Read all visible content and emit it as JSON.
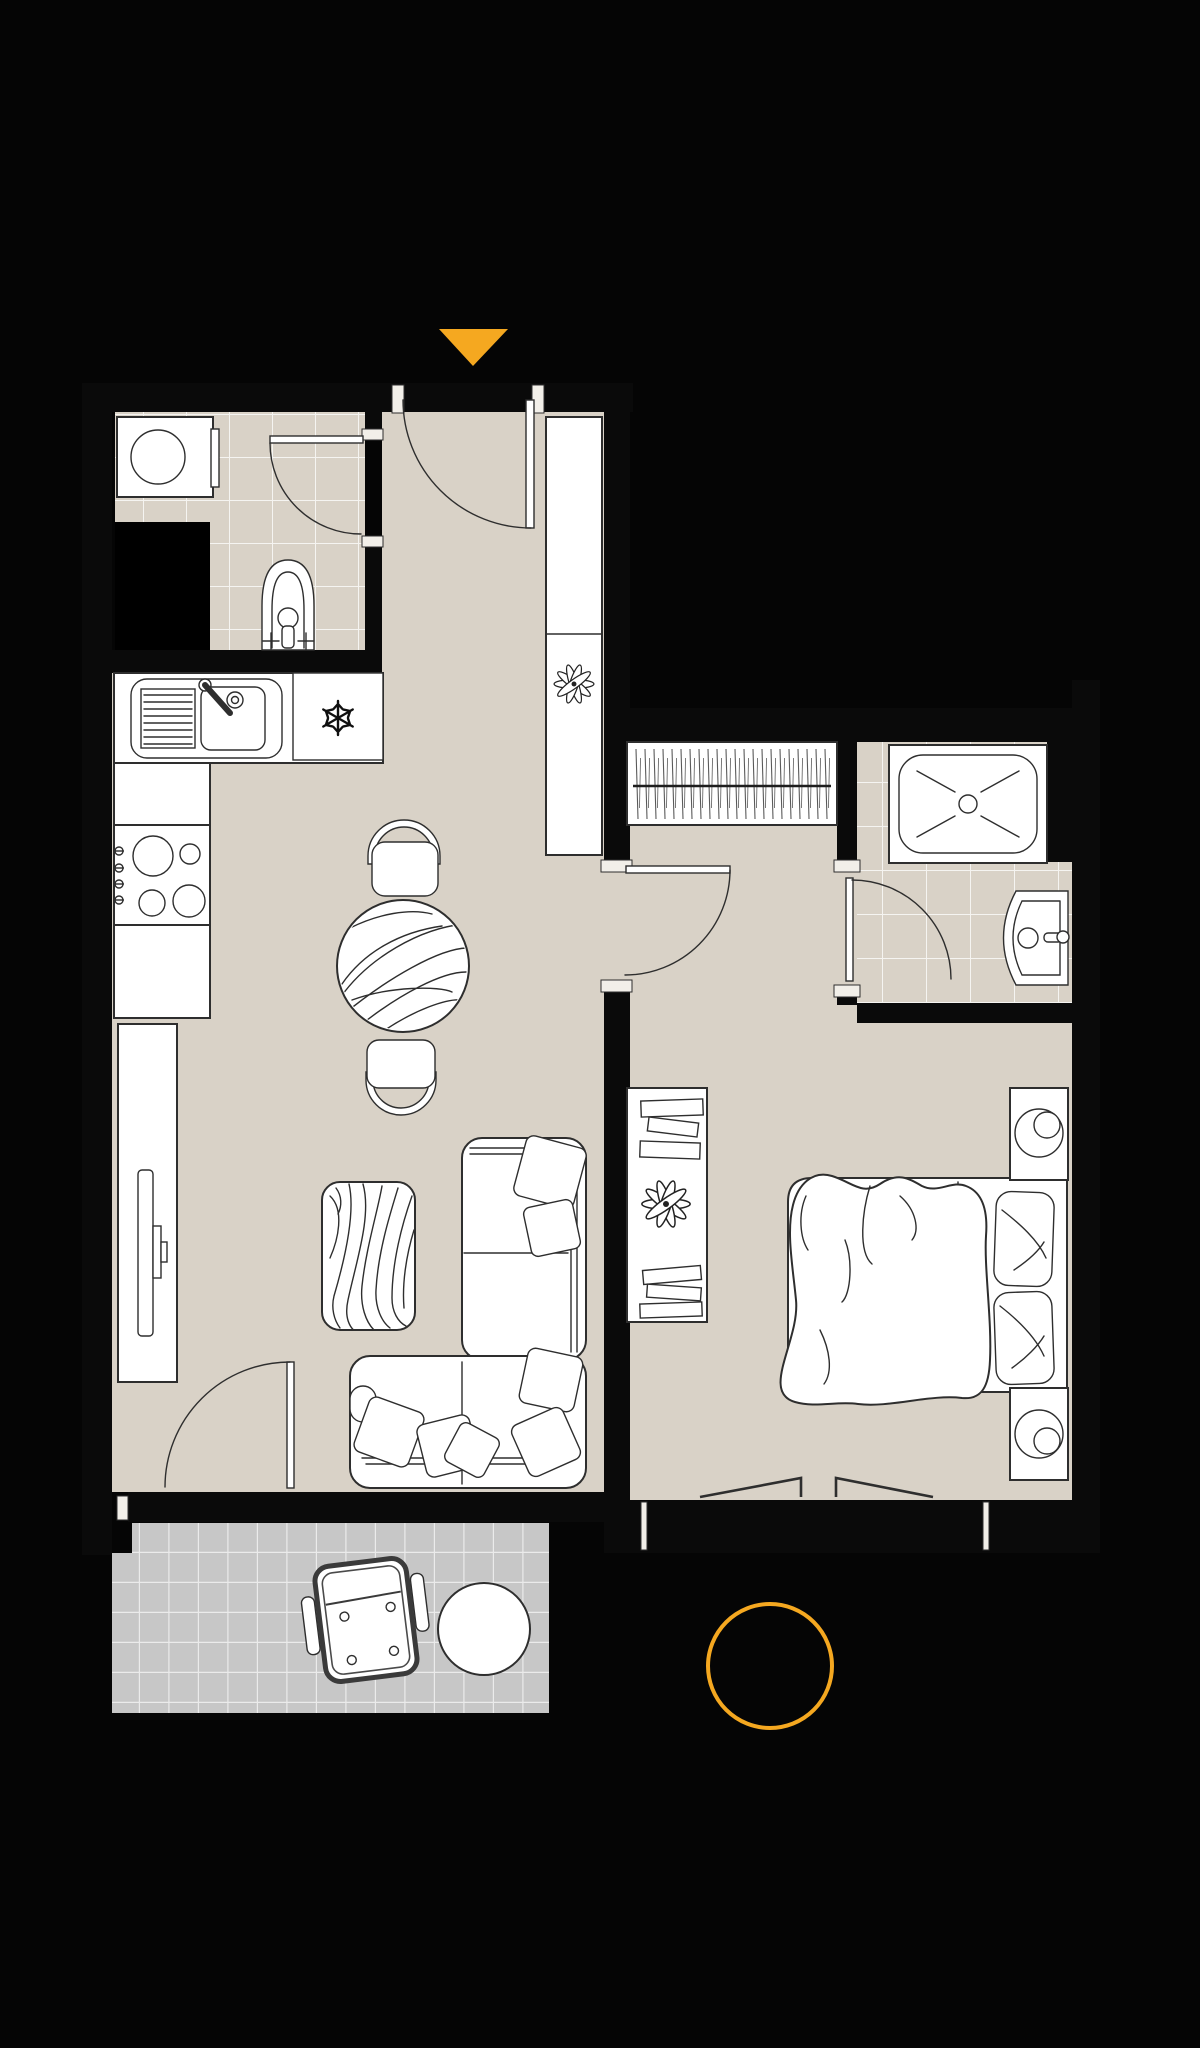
{
  "document": {
    "kind": "apartment-floor-plan-drawing",
    "has_text": false
  },
  "colors": {
    "background": "#050505",
    "wall": "#0a0a0a",
    "floor": "#d9d2c7",
    "tile_grid": "#ffffff",
    "balcony_floor": "#c7c7c7",
    "balcony_grid": "#ededed",
    "furniture_fill": "#ffffff",
    "furniture_line": "#2e2e2e",
    "soft_line": "#4a4a4a",
    "accent": "#f5a820",
    "niche": "#000000"
  },
  "markers": {
    "entrance": {
      "icon": "triangle-down-icon",
      "color": "#f5a820"
    },
    "highlight": {
      "icon": "circle-outline-icon",
      "color": "#f5a820"
    }
  },
  "rooms": [
    {
      "id": "bathroom",
      "fixtures": [
        "washing-machine",
        "toilet",
        "door",
        "tiled-floor"
      ]
    },
    {
      "id": "hallway",
      "fixtures": [
        "entrance-door",
        "tall-cabinet",
        "plant"
      ]
    },
    {
      "id": "kitchen-living-room",
      "fixtures": [
        "sink-counter",
        "freezer",
        "stove",
        "base-cabinets",
        "tv-sideboard",
        "tv",
        "dining-table",
        "dining-chair",
        "dining-chair",
        "zebra-rug",
        "corner-sofa",
        "sofa-pillows",
        "balcony-door"
      ]
    },
    {
      "id": "bedroom",
      "fixtures": [
        "built-in-wardrobe",
        "shelf-unit",
        "books",
        "plant",
        "double-bed",
        "duvet",
        "bed-pillows",
        "nightstand",
        "nightstand",
        "lamps",
        "window-leaves",
        "door"
      ]
    },
    {
      "id": "ensuite-bathroom",
      "fixtures": [
        "shower",
        "washbasin",
        "door",
        "tiled-floor"
      ]
    },
    {
      "id": "balcony",
      "fixtures": [
        "lounge-chair",
        "side-table",
        "tiled-floor"
      ]
    }
  ]
}
